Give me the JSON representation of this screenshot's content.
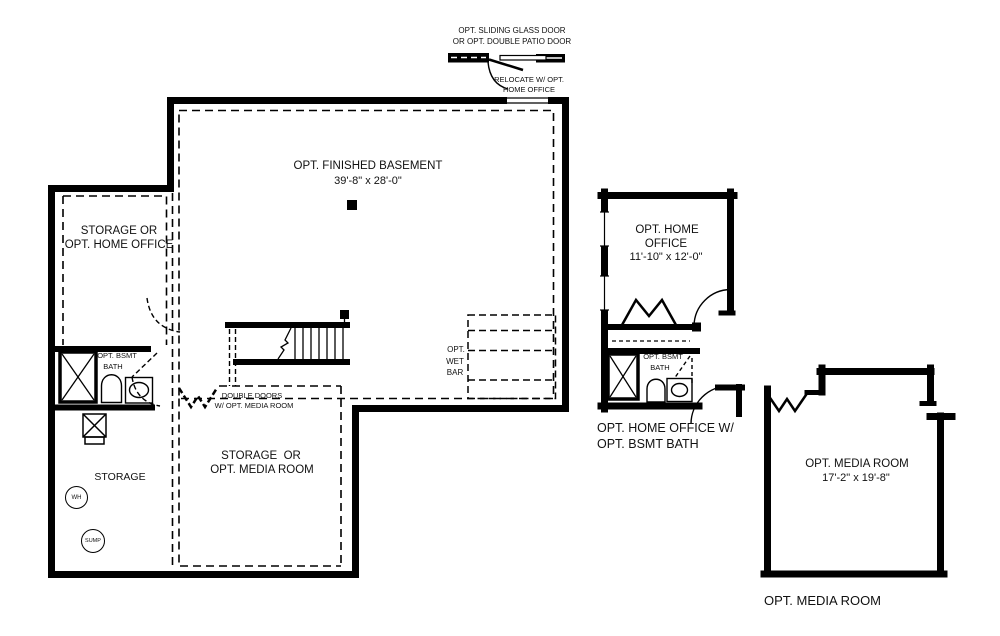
{
  "plan": {
    "door_note": {
      "line1": "OPT. SLIDING GLASS DOOR",
      "line2": "OR OPT. DOUBLE PATIO DOOR"
    },
    "relocate_note": {
      "line1": "RELOCATE W/ OPT.",
      "line2": "HOME OFFICE"
    },
    "main": {
      "finished_basement": {
        "name": "OPT. FINISHED BASEMENT",
        "dims": "39'-8\" x 28'-0\""
      },
      "storage_or_home_office": {
        "line1": "STORAGE OR",
        "line2": "OPT. HOME OFFICE"
      },
      "bsmt_bath": {
        "line1": "OPT. BSMT",
        "line2": "BATH"
      },
      "storage": "STORAGE",
      "water_heater": "WH",
      "sump_pump": "SUMP",
      "storage_or_media_room": {
        "line1": "STORAGE  OR",
        "line2": "OPT. MEDIA ROOM"
      },
      "double_doors_note": {
        "line1": "DOUBLE DOORS",
        "line2": "W/ OPT. MEDIA ROOM"
      },
      "wet_bar": {
        "line1": "OPT.",
        "line2": "WET",
        "line3": "BAR"
      }
    },
    "home_office_option": {
      "room": {
        "line1": "OPT. HOME",
        "line2": "OFFICE",
        "dims": "11'-10\" x 12'-0\""
      },
      "bath": {
        "line1": "OPT. BSMT",
        "line2": "BATH"
      },
      "caption": {
        "line1": "OPT. HOME OFFICE W/",
        "line2": "OPT. BSMT BATH"
      }
    },
    "media_room_option": {
      "room": {
        "name": "OPT. MEDIA ROOM",
        "dims": "17'-2\" x 19'-8\""
      },
      "caption": "OPT. MEDIA ROOM"
    },
    "colors": {
      "line": "#000000",
      "background": "#ffffff"
    }
  }
}
